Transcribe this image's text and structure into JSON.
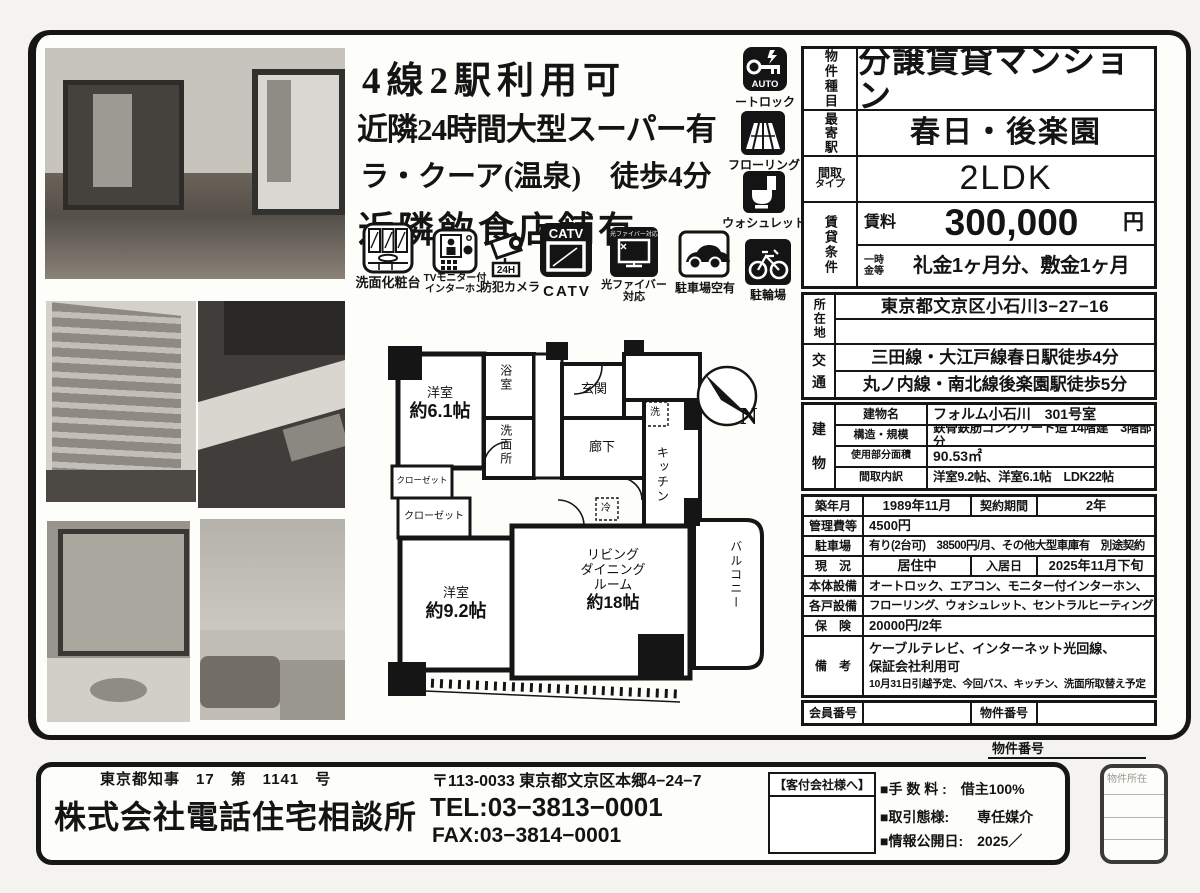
{
  "headlines": {
    "l1": "4線2駅利用可",
    "l2": "近隣24時間大型スーパー有",
    "l3": "ラ・クーア(温泉)　徒歩4分",
    "l4": "近隣飲食店舗有"
  },
  "icons": {
    "vanity": {
      "label": "洗面化粧台"
    },
    "intercom": {
      "label1": "TVモニター付",
      "label2": "インターホン"
    },
    "camera": {
      "label": "防犯カメラ",
      "badge": "24H"
    },
    "catv": {
      "label": "CATV",
      "icon_text": "CATV"
    },
    "fiber": {
      "label1": "光ファイバー",
      "label2": "対応",
      "icon_text": "光ファイバー対応"
    },
    "parking": {
      "label": "駐車場空有"
    },
    "autolock": {
      "label": "ートロック",
      "icon_text": "AUTO"
    },
    "flooring": {
      "label": "フローリング"
    },
    "washlet": {
      "label": "ウォシュレット"
    },
    "bicycle": {
      "label": "駐輪場"
    }
  },
  "spec": {
    "type_label": "物件種目",
    "type_value": "分譲賃貸マンション",
    "station_label": "最寄駅",
    "station_value": "春日・後楽園",
    "layout_label1": "間取",
    "layout_label2": "タイプ",
    "layout_value": "2LDK",
    "rent_section_label": "賃貸条件",
    "rent_label": "賃料",
    "rent_value": "300,000",
    "rent_unit": "円",
    "deposit_label1": "一時",
    "deposit_label2": "金等",
    "deposit_value": "礼金1ヶ月分、敷金1ヶ月",
    "address_label": "所在地",
    "address_value": "東京都文京区小石川3−27−16",
    "address_value2": "",
    "access_label1": "交",
    "access_label2": "通",
    "access_value1": "三田線・大江戸線春日駅徒歩4分",
    "access_value2": "丸ノ内線・南北線後楽園駅徒歩5分",
    "building_label1": "建",
    "building_label2": "物",
    "building_rows": [
      {
        "label": "建物名",
        "value": "フォルム小石川　301号室"
      },
      {
        "label": "構造・規模",
        "value": "鉄骨鉄筋コンクリート造 14階建　3階部分"
      },
      {
        "label": "使用部分面積",
        "value": "90.53㎡"
      },
      {
        "label": "間取内訳",
        "value": "洋室9.2帖、洋室6.1帖　LDK22帖"
      }
    ],
    "built_label": "築年月",
    "built_value": "1989年11月",
    "term_label": "契約期間",
    "term_value": "2年",
    "mgmt_label": "管理費等",
    "mgmt_value": "4500円",
    "parking_label": "駐車場",
    "parking_value": "有り(2台可)　38500円/月、その他大型車庫有　別途契約",
    "status_label": "現　況",
    "status_value": "居住中",
    "movein_label": "入居日",
    "movein_value": "2025年11月下旬",
    "equip1_label": "本体設備",
    "equip1_value": "オートロック、エアコン、モニター付インターホン、",
    "equip2_label": "各戸設備",
    "equip2_value": "フローリング、ウォシュレット、セントラルヒーティング",
    "ins_label": "保　険",
    "ins_value": "20000円/2年",
    "notes_label": "備　考",
    "notes_line1": "ケーブルテレビ、インターネット光回線、",
    "notes_line2": "保証会社利用可",
    "notes_line3": "10月31日引越予定、今回バス、キッチン、洗面所取替え予定",
    "member_label": "会員番号",
    "member_value": "",
    "propno_label": "物件番号",
    "propno_value": ""
  },
  "floorplan": {
    "room61_1": "洋室",
    "room61_2": "約6.1帖",
    "bath": "浴室",
    "entrance": "玄関",
    "washroom": "洗面所",
    "hallway": "廊下",
    "kitchen": "キッチン",
    "closet1": "クローゼット",
    "closet2": "クローゼット",
    "room92_1": "洋室",
    "room92_2": "約9.2帖",
    "living1": "リビング",
    "living2": "ダイニング",
    "living3": "ルーム",
    "living4": "約18帖",
    "balcony": "バルコニー",
    "north": "N",
    "washer": "洗",
    "fridge": "冷"
  },
  "footer": {
    "license": "東京都知事　17　第　1141　号",
    "company": "株式会社電話住宅相談所",
    "postal_address": "〒113-0033 東京都文京区本郷4−24−7",
    "tel": "TEL:03−3813−0001",
    "fax": "FAX:03−3814−0001",
    "agent_box_title": "【客付会社様へ】",
    "fee": "■手 数 料 :　借主100%",
    "deal": "■取引態様:　　専任媒介",
    "published": "■情報公開日:　2025／",
    "property_no_label": "物件番号",
    "side_box_label": "物件所在"
  }
}
